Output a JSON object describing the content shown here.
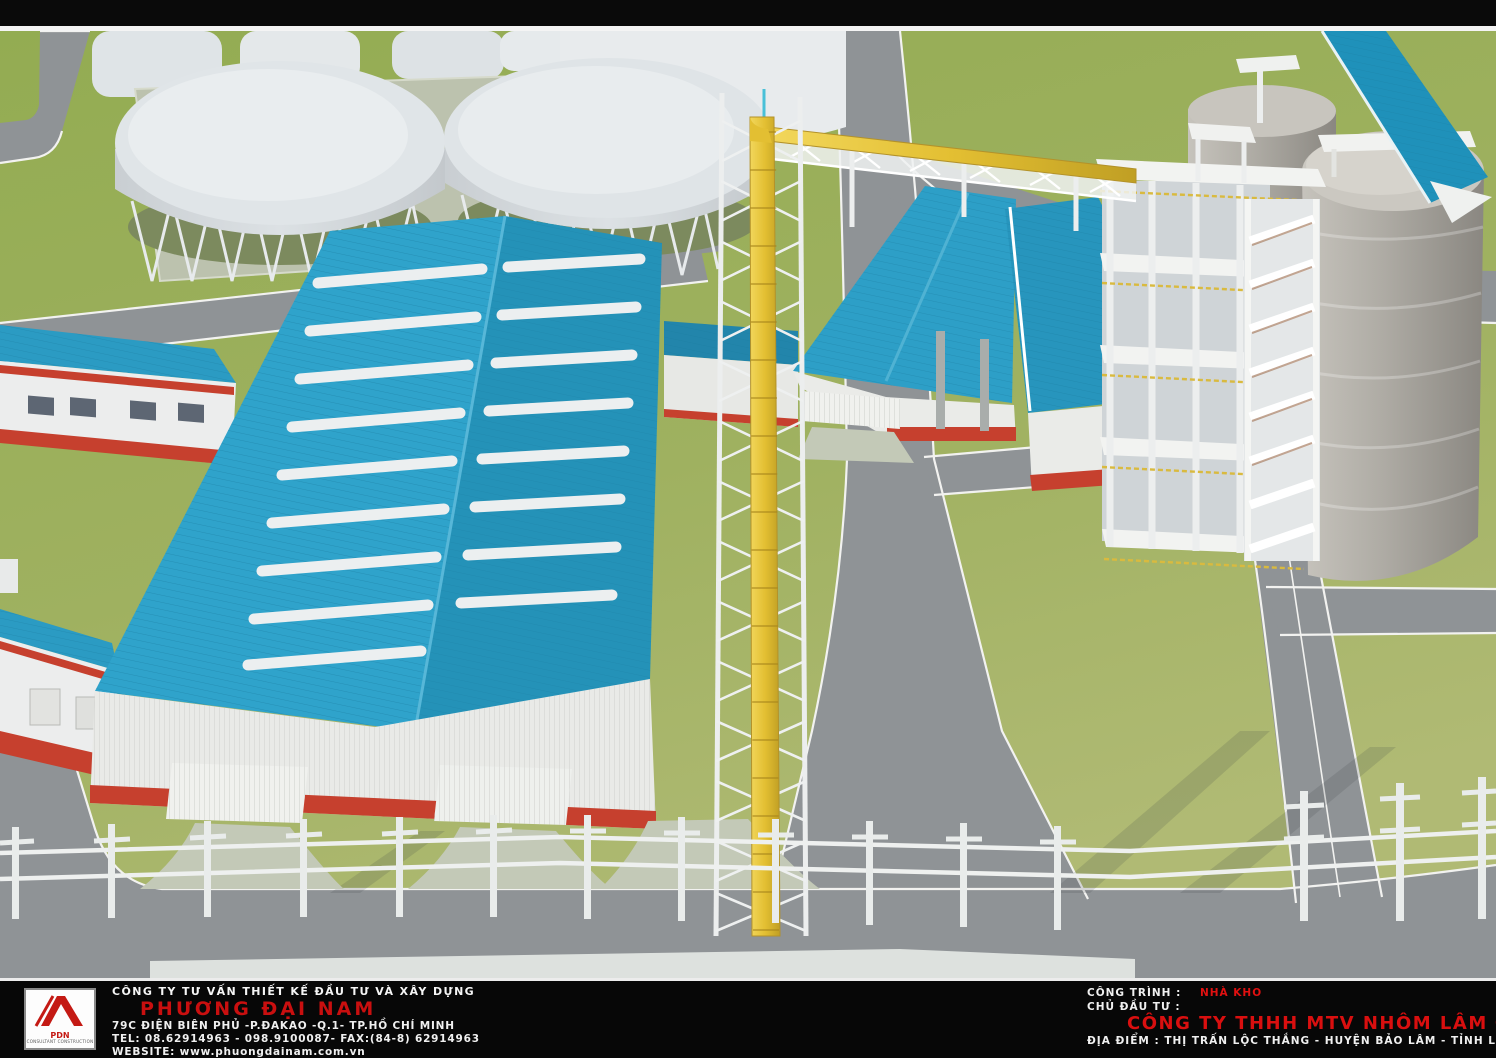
{
  "title_block": {
    "left": {
      "logo_abbr": "PDN",
      "logo_caption": "CONSULTANT CONSTRUCTION",
      "company_type": "CÔNG TY TƯ VẤN THIẾT KẾ ĐẦU TƯ VÀ XÂY DỰNG",
      "company_name": "PHƯƠNG ĐẠI NAM",
      "address": "79C ĐIỆN BIÊN PHỦ -P.ĐAKAO -Q.1- TP.HỒ CHÍ MINH",
      "tel": "TEL: 08.62914963 - 098.9100087- FAX:(84-8) 62914963",
      "website": "WEBSITE: www.phuongdainam.com.vn"
    },
    "right": {
      "project_label": "CÔNG TRÌNH :",
      "project_value": "NHÀ KHO",
      "investor_label": "CHỦ ĐẦU TƯ :",
      "investor_name": "CÔNG TY THHH MTV NHÔM LÂM ĐỒNG- VINACOMIN",
      "location": "ĐỊA ĐIỂM : THỊ TRẤN LỘC THẮNG - HUYỆN BẢO LÂM - TỈNH LÂM ĐỒNG"
    }
  },
  "scene": {
    "description": "Aerial 3D rendering of an industrial plant: large teal-roofed warehouse with white skylight strips, two elevated circular thickener tanks on lattice legs, twin teal-roofed halls, yellow elevated pipeline on white trestles, multi-storey white process structure with stair tower, concrete silos with teal conveyor gallery, office blocks, lawns, grey roads and white pipe racks."
  },
  "colors": {
    "roof_teal": "#2D9FC7",
    "roof_teal_dark": "#2492B8",
    "trim_red": "#C6402E",
    "wall_white": "#E9EAE7",
    "grass": "#9DB15C",
    "road_grey": "#8F9396",
    "pipe_yellow": "#E9C93F",
    "silo_concrete": "#A8A5A0",
    "accent_text_red": "#D90F0F"
  }
}
